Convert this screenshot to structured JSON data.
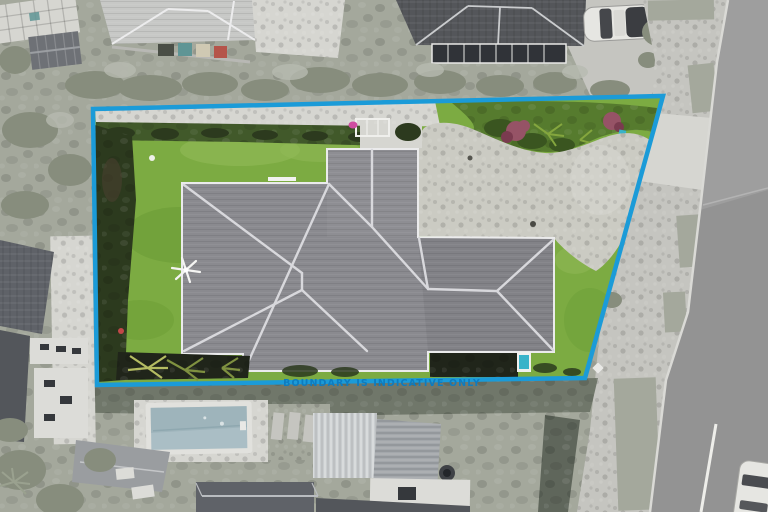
{
  "overlay": {
    "boundary_label": "BOUNDARY IS INDICATIVE ONLY"
  },
  "scene": {
    "type": "aerial-property-photograph",
    "features": [
      "main-house-hip-roof",
      "driveway",
      "front-lawn",
      "back-lawn",
      "boundary-outline",
      "top-garden-bed",
      "red-flowering-bushes",
      "left-hedge",
      "top-hedge",
      "flax-plants",
      "garage-roof",
      "dark-garden-bed",
      "wind-spinner",
      "clothesline",
      "neighbor-house-top-left",
      "neighbor-house-top-right",
      "parked-car-top",
      "parked-car-bottom-right",
      "street-road",
      "footpath-berm",
      "grass-verge",
      "vehicle-crossing",
      "neighbor-swimming-pool",
      "pool-deck",
      "stepping-stones",
      "neighbor-houses-bottom",
      "neighbor-houses-left"
    ]
  },
  "colors": {
    "boundary_line": "#1b9bd8",
    "boundary_text": "#0e7cc0",
    "lawn": "#7cab42",
    "lawn_light": "#92ba58",
    "lawn_dark": "#689a33",
    "lawn_worn": "#b3b184",
    "hedge_dark": "#2c3a1e",
    "hedge_mid": "#41592a",
    "garden_green": "#567b2e",
    "garden_dark": "#3a5520",
    "bush_red": "#965366",
    "bush_red_dark": "#7a3b4f",
    "tropical_leaf": "#84a63e",
    "teal_item": "#38b3c9",
    "pink_item": "#cf4da0",
    "flax_green": "#7f9140",
    "flax_light": "#b4bc62",
    "flower_red": "#c24848",
    "roof_gray": "#8a8a8f",
    "roof_ridge": "#d8d8dc",
    "eave": "#ebebec",
    "garage_roof": "#9aa0a5",
    "soil_dark": "#20251a",
    "driveway": "#cbcbc3",
    "concrete_light": "#d6d6d1",
    "concrete": "#c5c5c0",
    "veg_gray": "#a4a89c",
    "veg_gray_dark": "#878d7d",
    "veg_gray_light": "#b7bab0",
    "hedge_gray": "#70776a",
    "fence_gray": "#5f665b",
    "road": "#9e9e9e",
    "road_dark": "#8a8a8a",
    "lane_white": "#eeeeea",
    "kerb": "#dadad6",
    "neighbor_roof_light": "#c7c8c6",
    "neighbor_roof_mid": "#9a9da0",
    "neighbor_roof_dark": "#54565a",
    "window_dark": "#35383c",
    "wall_light": "#dcdcd8",
    "skylight": "#303338",
    "car_white": "#e6e6e2",
    "car_dark": "#3b3d41",
    "bin_teal": "#5f9595",
    "bin_cream": "#cfc9b3",
    "bin_red": "#b5544a",
    "pool_water": "#aabec5",
    "pool_water_dark": "#91a9b2",
    "pool_coping": "#e1e1dd",
    "metal_roof": "#a3a7ab",
    "louvre_roof": "#c9cdcf",
    "dark_roof": "#5f6268",
    "dark_roof2": "#53565b",
    "shed_roof": "#6e7176"
  }
}
